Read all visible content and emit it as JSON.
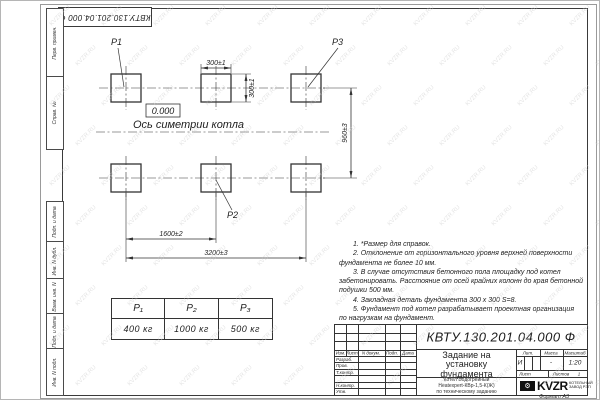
{
  "stamp": {
    "doc_number": "КВТУ.130.201.04.000   Ф"
  },
  "margin": {
    "cells": [
      {
        "label": "Перв. примен."
      },
      {
        "label": "Справ. №"
      },
      {
        "label": "Подп. и дата"
      },
      {
        "label": "Инв. N дубл."
      },
      {
        "label": "Взам. инв. N"
      },
      {
        "label": "Подп. и дата"
      },
      {
        "label": "Инв. N подл."
      }
    ]
  },
  "plan": {
    "pad_labels": {
      "p1": "Р1",
      "p2": "Р2",
      "p3": "Р3"
    },
    "elevation": "0.000",
    "axis_label": "Ось симетрии котла",
    "dims": {
      "pad_w": "300±1",
      "pad_h": "300±1",
      "rows": "960±3",
      "cols": "1600±2",
      "total": "3200±3"
    }
  },
  "loads_table": {
    "headers": [
      "Р₁",
      "Р₂",
      "Р₃"
    ],
    "values": [
      "400 кг",
      "1000 кг",
      "500 кг"
    ]
  },
  "notes": {
    "lines": [
      "1. *Размер для справок.",
      "2. Отклонение от горизонтального уровня верхней поверхности",
      "фундамента не более 10 мм.",
      "3. В случае отсутствия бетонного пола площадку под котел",
      "забетонировать. Расстояние от осей крайних колонн до края бетонной",
      "подушки 500 мм.",
      "4. Закладная деталь фундамента  300 х 300  S=8.",
      "5. Фундамент под котел разрабатывает проектная организация",
      "по нагрузкам на фундамент."
    ]
  },
  "title_block": {
    "doc_number": "КВТУ.130.201.04.000  Ф",
    "name_lines": [
      "Задание на",
      "установку",
      "фундамента"
    ],
    "product_lines": [
      "Котел Водогрейный",
      "Heatexpert-КВр-1,5-К(Ж)",
      "по техническому заданию"
    ],
    "header_cols": [
      "Изм.",
      "Лист",
      "N докум.",
      "Подп.",
      "Дата"
    ],
    "row_labels": [
      "Разраб.",
      "Пров.",
      "Т.контр.",
      "",
      "Н.контр.",
      "Утв."
    ],
    "lit_label": "Лит.",
    "mass_label": "Масса",
    "scale_label": "Масштаб",
    "lit_value": "И",
    "mass_value": "-",
    "scale_value": "1:20",
    "sheet_label": "Лист",
    "sheets_label": "Листов",
    "sheets_value": "1",
    "logo_text": "KVZR",
    "logo_caption1": "КОТЕЛЬНЫЙ",
    "logo_caption2": "ЗАВОД РЭП",
    "format_label": "Формат А3"
  },
  "watermark": {
    "text": "KVZR.RU"
  },
  "colors": {
    "line": "#333333",
    "watermark": "#cfcfcf"
  }
}
